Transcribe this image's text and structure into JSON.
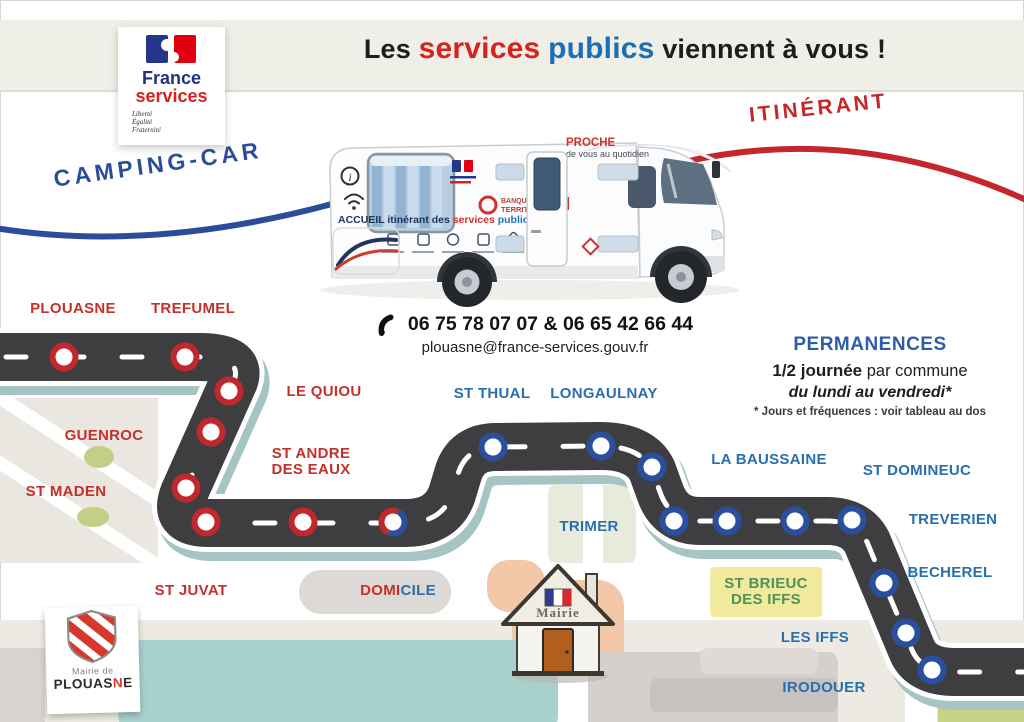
{
  "palette": {
    "band_bg": "#efeee7",
    "title_red": "#d6231f",
    "title_blue": "#1d6fb5",
    "camping_blue": "#2a4d9b",
    "itinerant_red": "#c4262b",
    "road": "#3e3e41",
    "road_shadow": "#a6c4c1",
    "stop_ring_red": "#c1272d",
    "stop_ring_blue": "#2b4f9f",
    "town_red": "#c5302c",
    "town_blue": "#2a6fad",
    "town_green": "#4f9158",
    "highlight_yellow": "#f1e99b",
    "permanences_blue": "#2d5da9"
  },
  "header": {
    "title_parts": {
      "p1": "Les",
      "p2": "services",
      "p3": "publics",
      "p4": "viennent à vous !"
    }
  },
  "fs_logo": {
    "line1": "France",
    "line2": "services",
    "motto1": "Liberté",
    "motto2": "Égalité",
    "motto3": "Fraternité"
  },
  "banners": {
    "left": "CAMPING-CAR",
    "right": "ITINÉRANT"
  },
  "van": {
    "proche": "PROCHE",
    "proche_sub": "de vous au quotidien",
    "side_prefix": "ACCUEIL itinérant des ",
    "side_services": "services",
    "side_publics": " publics",
    "partner_line1": "BANQUE des",
    "partner_line2": "TERRITOIRES",
    "info_icon": "i"
  },
  "contact": {
    "phones": "06 75 78 07 07 & 06 65 42 66 44",
    "email": "plouasne@france-services.gouv.fr"
  },
  "permanences": {
    "title": "PERMANENCES",
    "line1_bold": "1/2 journée",
    "line1_rest": " par commune",
    "line2": "du lundi au vendredi*",
    "footnote": "* Jours et fréquences : voir tableau au dos"
  },
  "mairie_house": {
    "label": "Mairie"
  },
  "plouasne_card": {
    "line1": "Mairie de",
    "name_pre": "PLOUAS",
    "name_accent": "N",
    "name_post": "E"
  },
  "map": {
    "towns": [
      {
        "id": "plouasne",
        "lines": [
          "PLOUASNE"
        ],
        "color": "red",
        "x": 73,
        "y": 309
      },
      {
        "id": "trefumel",
        "lines": [
          "TREFUMEL"
        ],
        "color": "red",
        "x": 193,
        "y": 309
      },
      {
        "id": "le-quiou",
        "lines": [
          "LE QUIOU"
        ],
        "color": "red",
        "x": 324,
        "y": 392
      },
      {
        "id": "guenroc",
        "lines": [
          "GUENROC"
        ],
        "color": "red",
        "x": 104,
        "y": 436
      },
      {
        "id": "st-andre-des-eaux",
        "lines": [
          "ST ANDRE",
          "DES EAUX"
        ],
        "color": "red",
        "x": 311,
        "y": 462
      },
      {
        "id": "st-maden",
        "lines": [
          "ST MADEN"
        ],
        "color": "red",
        "x": 66,
        "y": 492
      },
      {
        "id": "st-juvat",
        "lines": [
          "ST JUVAT"
        ],
        "color": "red",
        "x": 191,
        "y": 591
      },
      {
        "id": "domicile",
        "lines": [
          "DOMICILE"
        ],
        "color": "red",
        "x": 398,
        "y": 591,
        "split": [
          "DOMI",
          "CILE"
        ]
      },
      {
        "id": "st-thual",
        "lines": [
          "ST THUAL"
        ],
        "color": "blue",
        "x": 492,
        "y": 394
      },
      {
        "id": "longaulnay",
        "lines": [
          "LONGAULNAY"
        ],
        "color": "blue",
        "x": 604,
        "y": 394
      },
      {
        "id": "la-baussaine",
        "lines": [
          "LA BAUSSAINE"
        ],
        "color": "blue",
        "x": 769,
        "y": 460
      },
      {
        "id": "st-domineuc",
        "lines": [
          "ST DOMINEUC"
        ],
        "color": "blue",
        "x": 917,
        "y": 471
      },
      {
        "id": "trimer",
        "lines": [
          "TRIMER"
        ],
        "color": "blue",
        "x": 589,
        "y": 527
      },
      {
        "id": "treverien",
        "lines": [
          "TREVERIEN"
        ],
        "color": "blue",
        "x": 953,
        "y": 520
      },
      {
        "id": "becherel",
        "lines": [
          "BECHEREL"
        ],
        "color": "blue",
        "x": 950,
        "y": 573
      },
      {
        "id": "st-brieuc-des-iffs",
        "lines": [
          "ST BRIEUC",
          "DES IFFS"
        ],
        "color": "green",
        "x": 766,
        "y": 592,
        "highlight": true
      },
      {
        "id": "les-iffs",
        "lines": [
          "LES IFFS"
        ],
        "color": "blue",
        "x": 815,
        "y": 638
      },
      {
        "id": "irodouer",
        "lines": [
          "IRODOUER"
        ],
        "color": "blue",
        "x": 824,
        "y": 688
      }
    ],
    "stops": [
      {
        "x": 64,
        "y": 77,
        "ring": "red"
      },
      {
        "x": 185,
        "y": 77,
        "ring": "red"
      },
      {
        "x": 229,
        "y": 111,
        "ring": "red"
      },
      {
        "x": 211,
        "y": 152,
        "ring": "red"
      },
      {
        "x": 186,
        "y": 208,
        "ring": "red"
      },
      {
        "x": 206,
        "y": 242,
        "ring": "red"
      },
      {
        "x": 303,
        "y": 242,
        "ring": "red"
      },
      {
        "x": 393,
        "y": 242,
        "ring": "split"
      },
      {
        "x": 493,
        "y": 167,
        "ring": "blue"
      },
      {
        "x": 601,
        "y": 166,
        "ring": "blue"
      },
      {
        "x": 652,
        "y": 187,
        "ring": "blue"
      },
      {
        "x": 674,
        "y": 241,
        "ring": "blue"
      },
      {
        "x": 727,
        "y": 241,
        "ring": "blue"
      },
      {
        "x": 795,
        "y": 241,
        "ring": "blue"
      },
      {
        "x": 852,
        "y": 240,
        "ring": "blue"
      },
      {
        "x": 884,
        "y": 303,
        "ring": "blue"
      },
      {
        "x": 906,
        "y": 353,
        "ring": "blue"
      },
      {
        "x": 932,
        "y": 390,
        "ring": "blue"
      }
    ]
  }
}
